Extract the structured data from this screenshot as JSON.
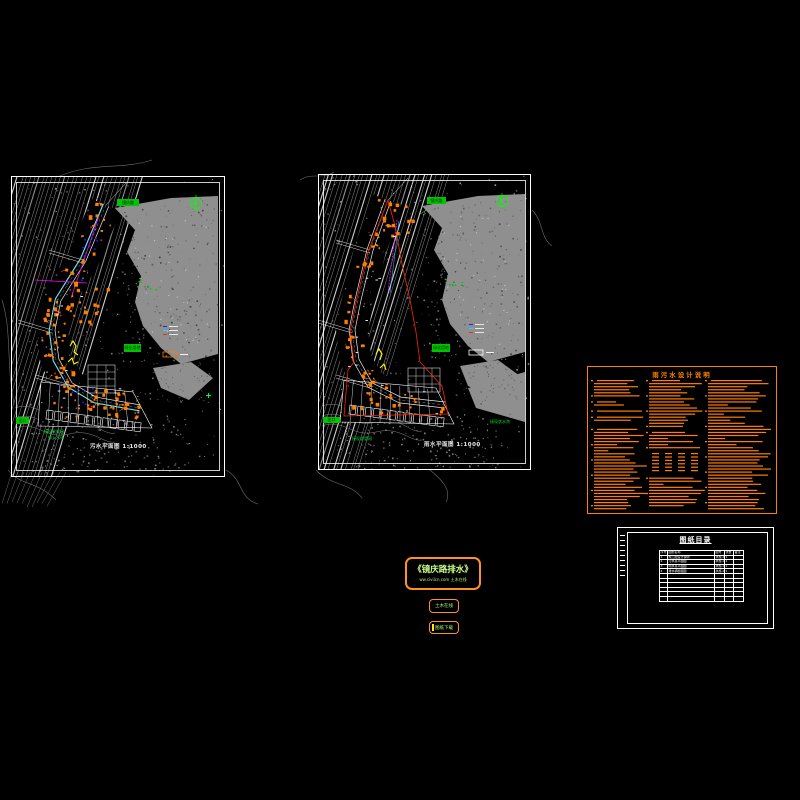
{
  "app": {
    "type": "CAD drawing viewport",
    "background": "#000000"
  },
  "colors": {
    "accent_orange": "#FF7F00",
    "green": "#00C400",
    "white": "#FFFFFF",
    "gray": "#8F8F8F",
    "cyan": "#00E5FF",
    "magenta": "#FF00FF",
    "red": "#FF2020",
    "yellow": "#FFFF00",
    "blue": "#2020FF",
    "title_text": "#CCFF8C"
  },
  "left_map": {
    "name": "sewage-plan",
    "scale_label": "污水平面图 1:1000",
    "labels": {
      "road": "镜庆路",
      "area": "绿化用地",
      "exit": "出口",
      "note1": "接现状管网",
      "note2": "排入水体"
    }
  },
  "right_map": {
    "name": "storm-plan",
    "scale_label": "雨水平面图 1:1000",
    "labels": {
      "road": "镜庆路",
      "area": "绿化用地",
      "exit": "出口",
      "note1": "接现状管网",
      "outfall": "接现状水沟"
    }
  },
  "notes_panel": {
    "title": "雨污水设计说明"
  },
  "sheet": {
    "title": "图纸目录",
    "table": {
      "headers": [
        "序号",
        "图纸名称",
        "图号",
        "张数",
        "备注"
      ],
      "rows": [
        [
          "1",
          "施工图设计说明",
          "水施-01",
          "1",
          ""
        ],
        [
          "2",
          "污水总平面图",
          "水施-02",
          "1",
          ""
        ],
        [
          "3",
          "雨水总平面图",
          "水施-03",
          "1",
          ""
        ],
        [
          "4",
          "排水横断面图",
          "水施-04",
          "1",
          ""
        ]
      ],
      "empty_rows": 6
    }
  },
  "title_box": {
    "title": "《镜庆路排水》",
    "watermark": "ww.civilcn.com 土木在线"
  },
  "badges": [
    {
      "label": "土木在线"
    },
    {
      "label": "图纸下载"
    }
  ]
}
